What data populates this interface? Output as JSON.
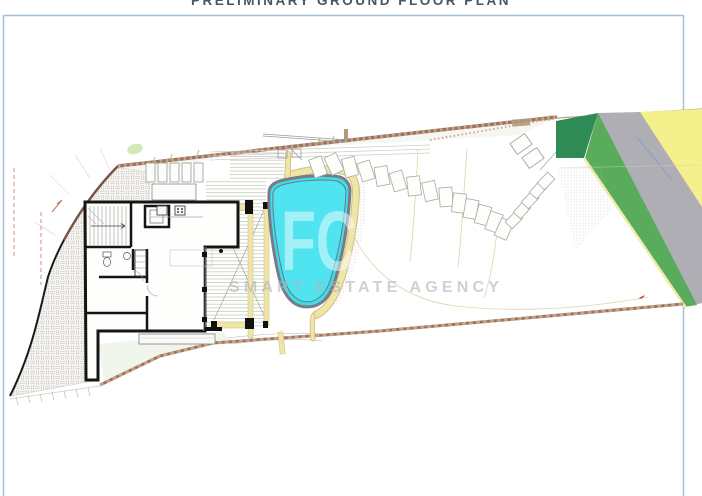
{
  "title": "PRELIMINARY GROUND FLOOR PLAN",
  "watermark": {
    "logo": "FC",
    "tagline": "SMART ESTATE AGENCY"
  },
  "plan": {
    "drawing_type": "architectural site / ground floor plan",
    "zones": [
      {
        "name": "pool",
        "color": "#3BDFEC",
        "label": "swimming pool"
      },
      {
        "name": "pool-coping",
        "color": "#F0E5A8",
        "label": "pool coping / paths"
      },
      {
        "name": "dark-green-zone",
        "color": "#2F8B55",
        "label": "dark green planting strip"
      },
      {
        "name": "green-zone",
        "color": "#58AC5C",
        "label": "green planting strip"
      },
      {
        "name": "grey-zone",
        "color": "#AEAEB4",
        "label": "grey road strip"
      },
      {
        "name": "yellow-zone",
        "color": "#F4F08C",
        "label": "yellow strip"
      },
      {
        "name": "boundary-wall",
        "color": "#9B7262",
        "label": "boundary walls"
      },
      {
        "name": "frame",
        "color": "#A6C0DA",
        "label": "sheet border"
      }
    ]
  }
}
